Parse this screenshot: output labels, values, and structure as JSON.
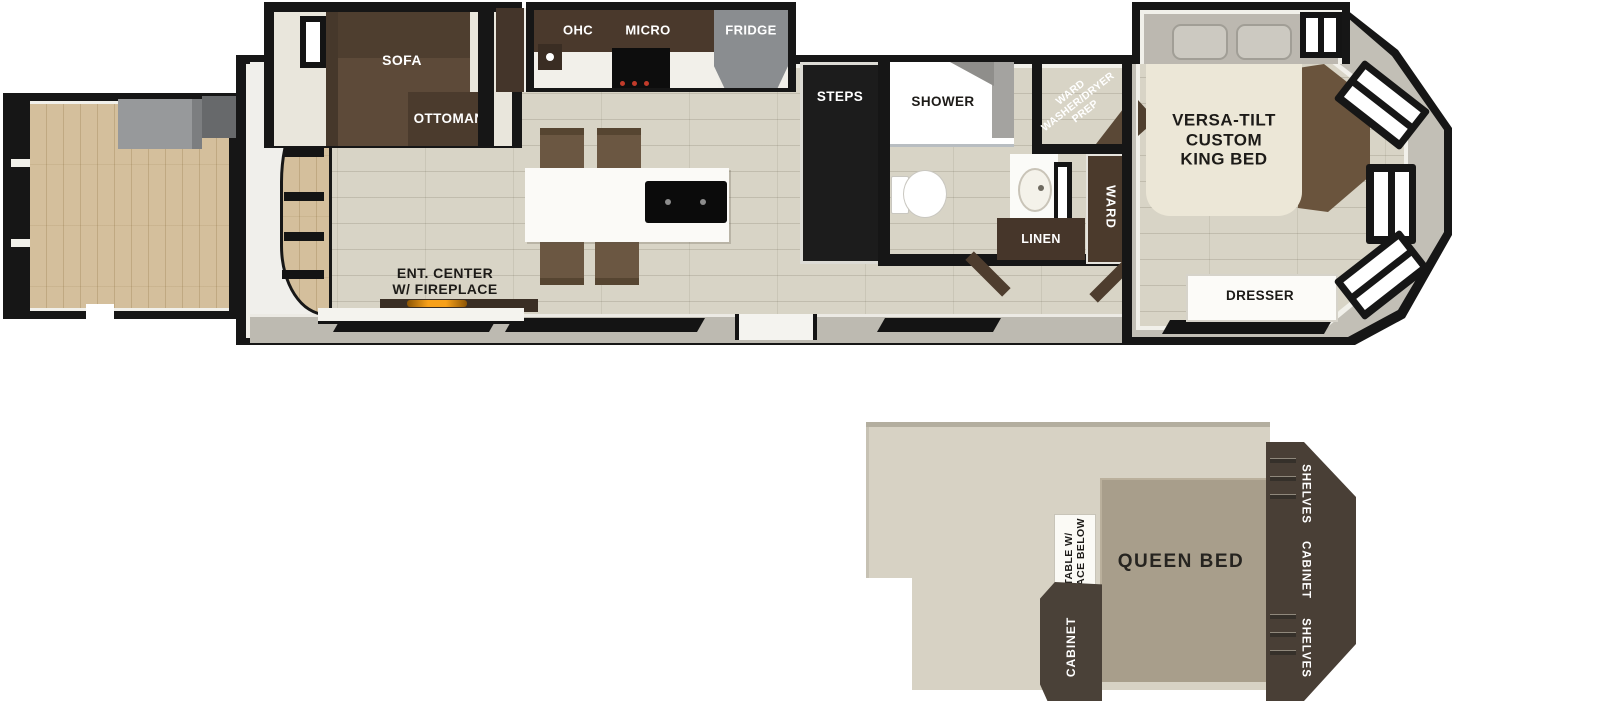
{
  "colors": {
    "wall_black": "#161616",
    "interior_floor": "#d8d4c6",
    "deck_wood": "#d4bf9c",
    "cabinet_dark_brown": "#46362a",
    "sofa_brown": "#5d4a39",
    "fridge_gray": "#8a8d90",
    "counter_white": "#f4f3ee",
    "bed_cream": "#ece7d7",
    "steps_black": "#1c1c1c",
    "fireplace_orange": "#f09a18",
    "exterior_band_gray": "#bdbab1",
    "loft_floor": "#d7d2c4",
    "queen_bed_tan": "#a89e8b",
    "loft_cabinet_brown": "#493f36"
  },
  "main": {
    "sofa": "SOFA",
    "ottoman": "OTTOMAN",
    "ohc": "OHC",
    "micro": "MICRO",
    "fridge": "FRIDGE",
    "steps": "STEPS",
    "shower": "SHOWER",
    "wdp_line1": "WARD",
    "wdp_line2": "WASHER/DRYER",
    "wdp_line3": "PREP",
    "king_line1": "VERSA-TILT",
    "king_line2": "CUSTOM",
    "king_line3": "KING BED",
    "linen": "LINEN",
    "ward": "WARD",
    "dresser": "DRESSER",
    "ent_line1": "ENT. CENTER",
    "ent_line2": "W/ FIREPLACE"
  },
  "loft": {
    "table_line1": "TABLE W/",
    "table_line2": "SPACE BELOW",
    "queen_bed": "QUEEN BED",
    "cabinet_lower": "CABINET",
    "shelves_top": "SHELVES",
    "cabinet_right": "CABINET",
    "shelves_bottom": "SHELVES"
  }
}
